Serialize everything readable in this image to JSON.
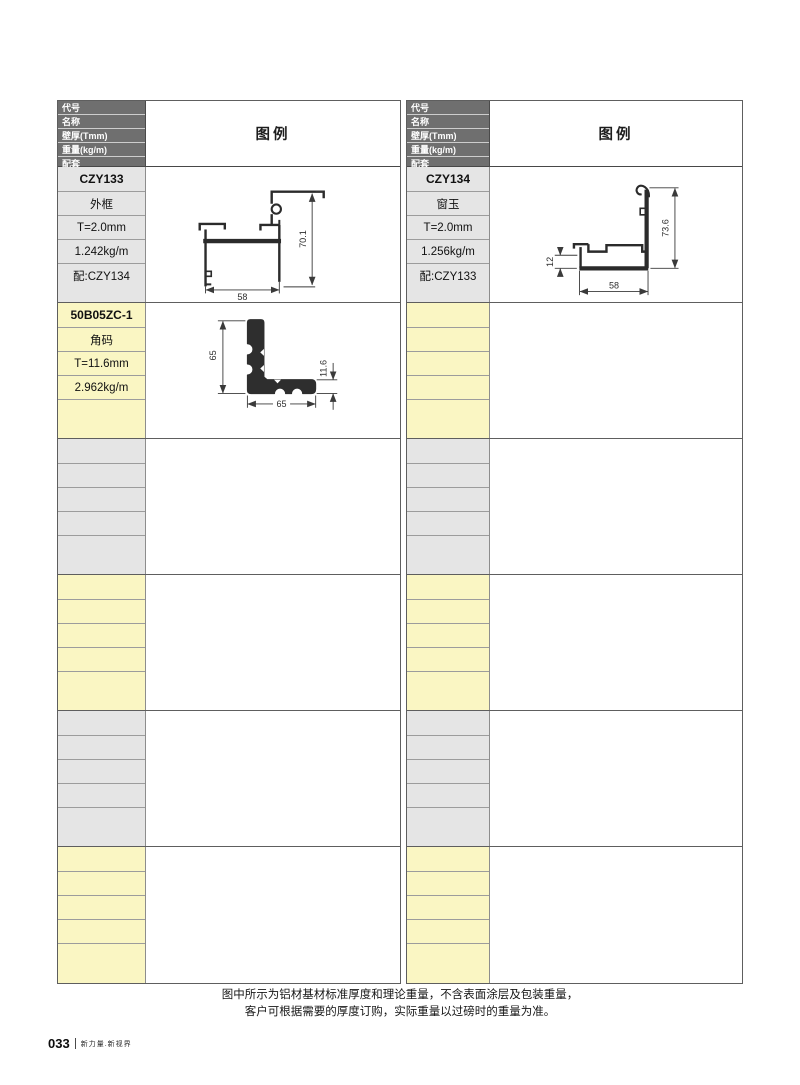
{
  "page": {
    "legend_label": "图例",
    "field_labels": [
      "代号",
      "名称",
      "壁厚(Tmm)",
      "重量(kg/m)",
      "配套"
    ],
    "note_line1": "图中所示为铝材基材标准厚度和理论重量，不含表面涂层及包装重量，",
    "note_line2": "客户可根据需要的厚度订购，实际重量以过磅时的重量为准。",
    "footer": {
      "page_number": "033",
      "slogan": "新力量.新视界"
    }
  },
  "colors": {
    "header_dark": "#6f6f6f",
    "row_gray": "#e5e5e5",
    "row_yellow": "#faf6c3",
    "profile_line": "#2b2b2b",
    "dimension_line": "#3a3a3a"
  },
  "tables": [
    {
      "id": "left",
      "groups": [
        {
          "tone": "gray",
          "code": "CZY133",
          "name": "外框",
          "thickness": "T=2.0mm",
          "weight": "1.242kg/m",
          "match": "配:CZY134",
          "diagram": "czy133",
          "dims": {
            "bottom": "58",
            "side": "70.1"
          }
        },
        {
          "tone": "yellow",
          "code": "50B05ZC-1",
          "name": "角码",
          "thickness": "T=11.6mm",
          "weight": "2.962kg/m",
          "match": "",
          "diagram": "bracket",
          "dims": {
            "left": "65",
            "bottom": "65",
            "right": "11.6"
          }
        },
        {
          "tone": "gray"
        },
        {
          "tone": "yellow"
        },
        {
          "tone": "gray"
        },
        {
          "tone": "yellow"
        }
      ]
    },
    {
      "id": "right",
      "groups": [
        {
          "tone": "gray",
          "code": "CZY134",
          "name": "窗玉",
          "thickness": "T=2.0mm",
          "weight": "1.256kg/m",
          "match": "配:CZY133",
          "diagram": "czy134",
          "dims": {
            "left": "12",
            "bottom": "58",
            "side": "73.6"
          }
        },
        {
          "tone": "yellow"
        },
        {
          "tone": "gray"
        },
        {
          "tone": "yellow"
        },
        {
          "tone": "gray"
        },
        {
          "tone": "yellow"
        }
      ]
    }
  ]
}
